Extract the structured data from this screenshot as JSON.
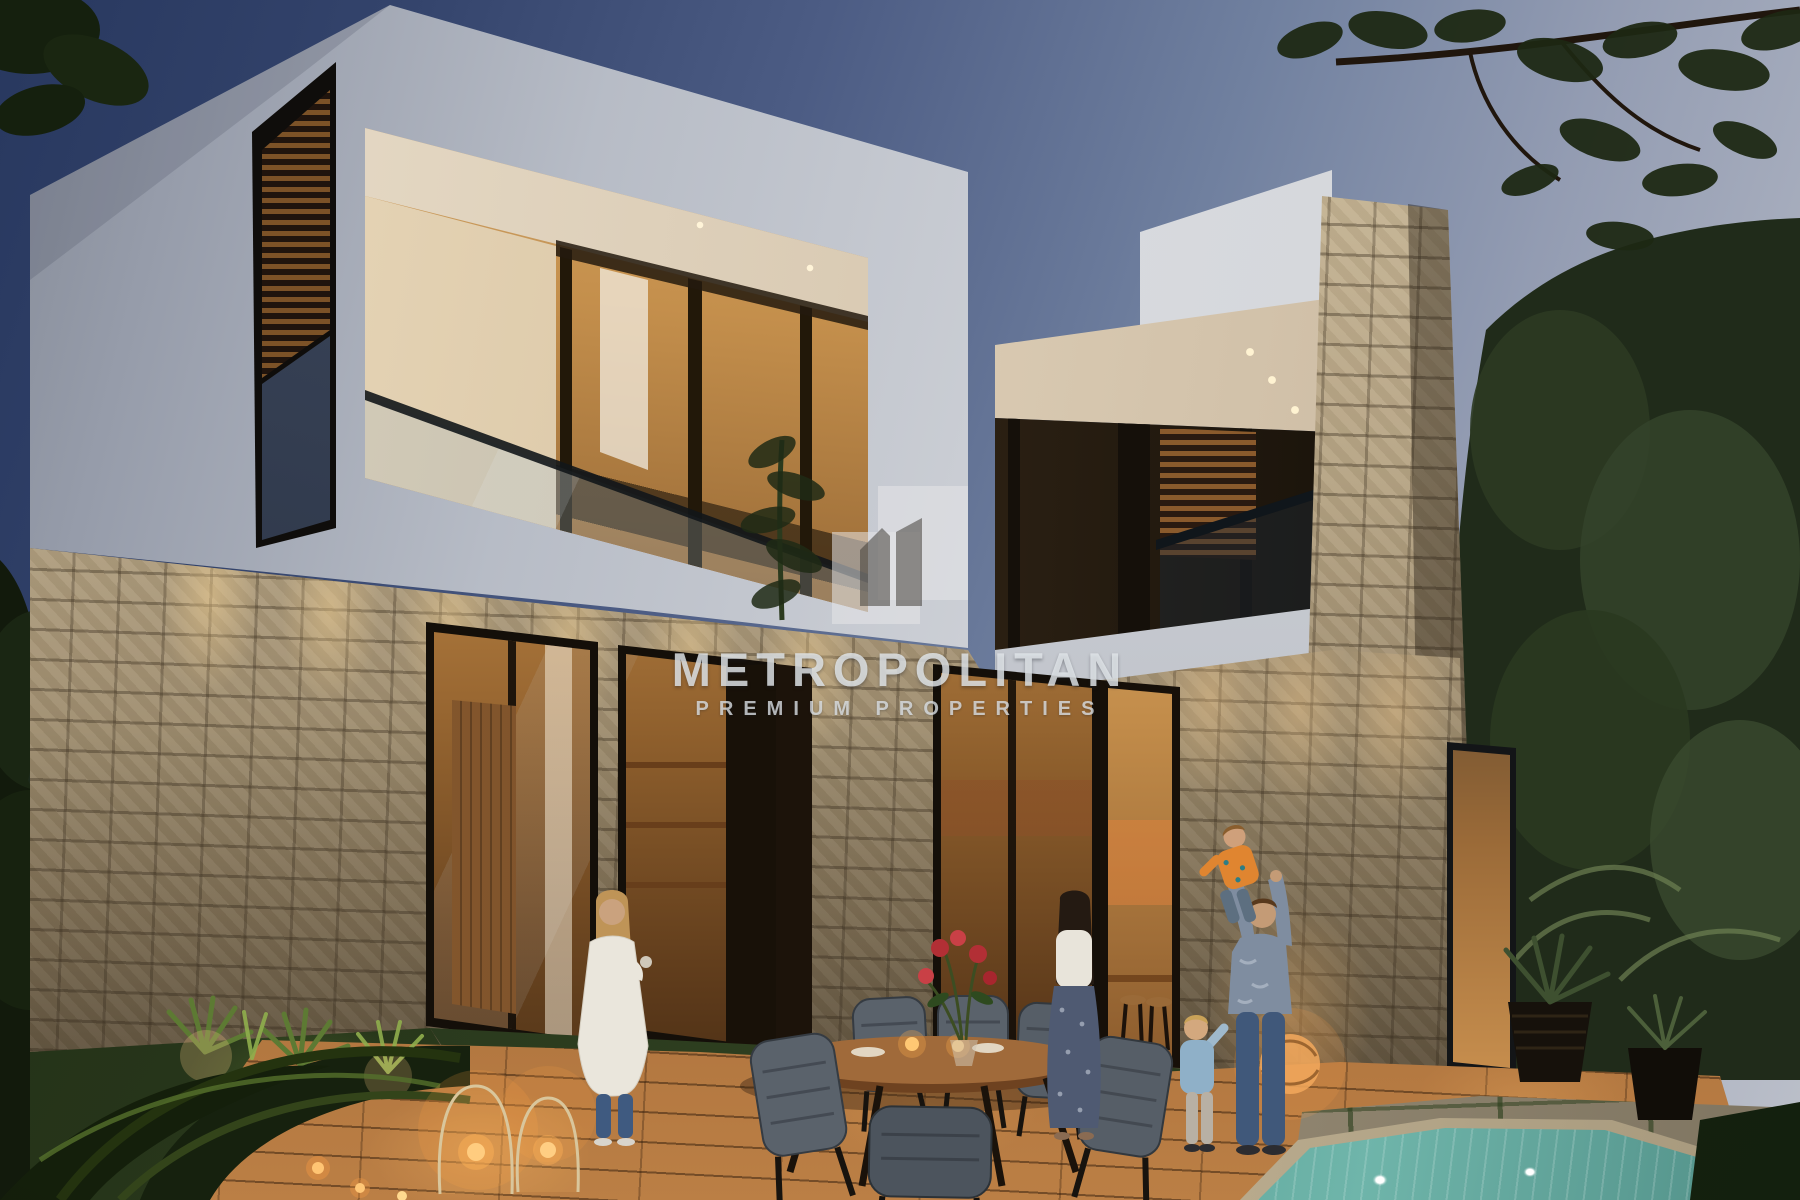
{
  "watermark": {
    "brand": "METROPOLITAN",
    "tagline": "PREMIUM PROPERTIES",
    "logo_icon": "metropolitan-buildings-logo"
  },
  "scene": {
    "type": "architectural-render-photo",
    "time_of_day": "dusk",
    "subject": "two-storey modern villa, stone-clad ground floor, white upper volumes, lit interiors, terrace with outdoor dining set, family of five, candle lanterns, plunge pool and garden",
    "entities": [
      "villa",
      "balcony",
      "glass-railing",
      "wood-slat-screen",
      "stone-column",
      "terrace-deck",
      "dining-table",
      "outdoor-chairs",
      "flower-bouquet",
      "candle-lanterns",
      "rattan-lamp",
      "planters",
      "pool",
      "garden-plants",
      "woman-in-white",
      "mother",
      "father",
      "lifted-child",
      "toddler"
    ]
  },
  "palette": {
    "sky_top": "#28385f",
    "sky_horizon": "#bcc0ca",
    "facade_white": "#d5d7db",
    "stone_tan": "#b5a383",
    "window_glow": "#d2a362",
    "deck_wood": "#a86e3a",
    "pool_water": "#57a095",
    "foliage_dark": "#232e1d",
    "watermark_text": "#e2e6ea"
  }
}
